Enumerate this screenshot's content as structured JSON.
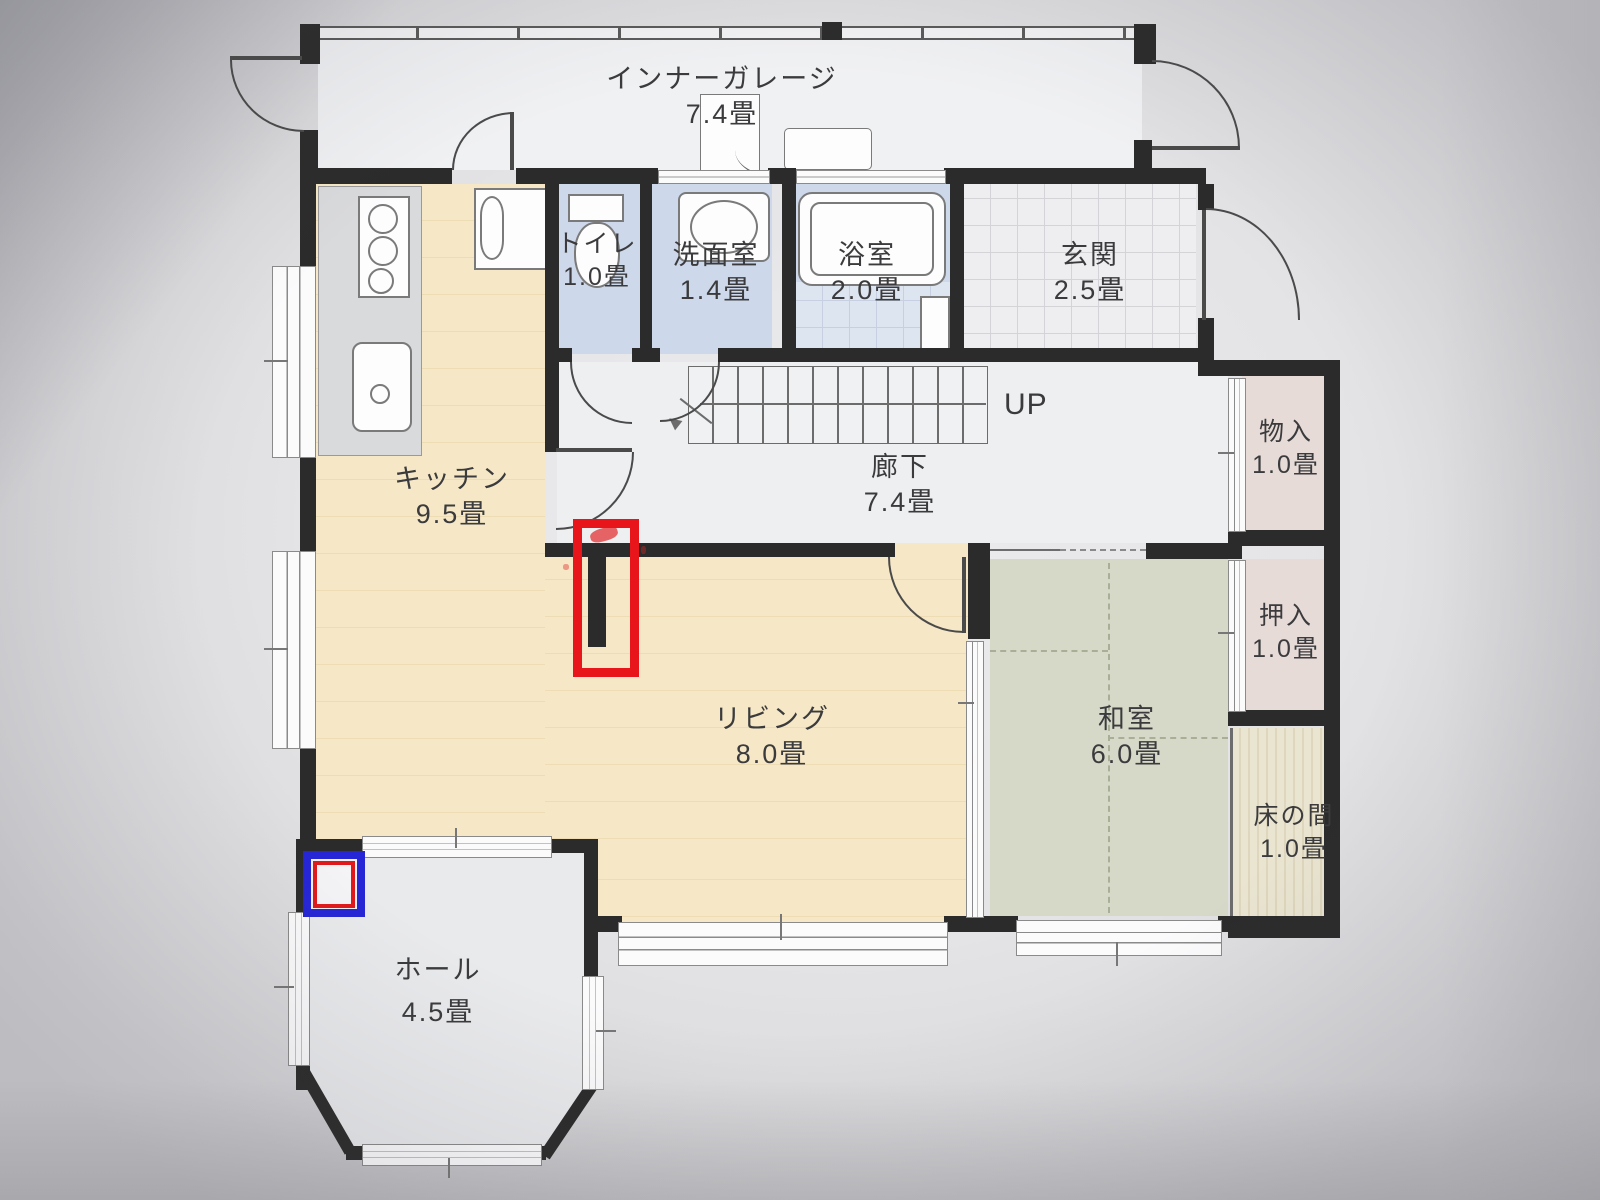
{
  "document": {
    "type": "floor-plan-photo",
    "floor": "1F"
  },
  "rooms": [
    {
      "id": "garage",
      "name": "インナーガレージ",
      "size": "7.4畳"
    },
    {
      "id": "toilet",
      "name": "トイレ",
      "size": "1.0畳"
    },
    {
      "id": "washroom",
      "name": "洗面室",
      "size": "1.4畳"
    },
    {
      "id": "bathroom",
      "name": "浴室",
      "size": "2.0畳"
    },
    {
      "id": "entrance",
      "name": "玄関",
      "size": "2.5畳"
    },
    {
      "id": "corridor",
      "name": "廊下",
      "size": "7.4畳"
    },
    {
      "id": "storage",
      "name": "物入",
      "size": "1.0畳"
    },
    {
      "id": "kitchen",
      "name": "キッチン",
      "size": "9.5畳"
    },
    {
      "id": "closet",
      "name": "押入",
      "size": "1.0畳"
    },
    {
      "id": "living",
      "name": "リビング",
      "size": "8.0畳"
    },
    {
      "id": "japanese-room",
      "name": "和室",
      "size": "6.0畳"
    },
    {
      "id": "tokonoma",
      "name": "床の間",
      "size": "1.0畳"
    },
    {
      "id": "hall",
      "name": "ホール",
      "size": "4.5畳"
    }
  ],
  "stairs": {
    "direction_label": "UP"
  },
  "annotations": [
    {
      "shape": "rectangle",
      "color": "red",
      "target": "wall stub between kitchen and living"
    },
    {
      "shape": "rectangle",
      "color": "blue-with-red-inner",
      "target": "hall top-left corner"
    }
  ],
  "colors": {
    "wall": "#2b2b2b",
    "flooring": "#f6e8c6",
    "tatami": "#d6d9c8",
    "wet_room": "#cdd8ea",
    "closet": "#e6dbd7",
    "tokonoma": "#eae5d1",
    "annotation_red": "#e8151b",
    "annotation_blue": "#2626d6"
  }
}
